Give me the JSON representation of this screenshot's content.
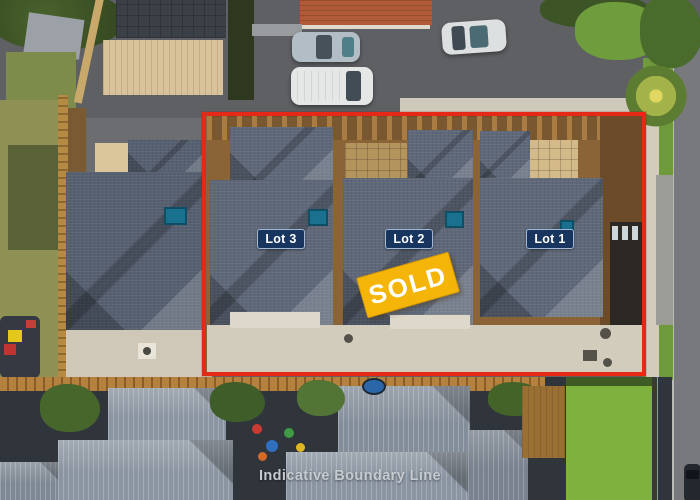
{
  "image": {
    "type": "aerial-property-photo",
    "caption": "Indicative Boundary Line"
  },
  "overlays": {
    "boundary": {
      "color": "#e62817"
    },
    "lots": [
      {
        "label": "Lot 3"
      },
      {
        "label": "Lot 2"
      },
      {
        "label": "Lot 1"
      }
    ],
    "sold_banner": {
      "label": "SOLD",
      "bg_color": "#f5b508",
      "text_color": "#ffffff"
    },
    "lot_label_style": {
      "bg_color": "#17355e",
      "text_color": "#ffffff"
    }
  }
}
